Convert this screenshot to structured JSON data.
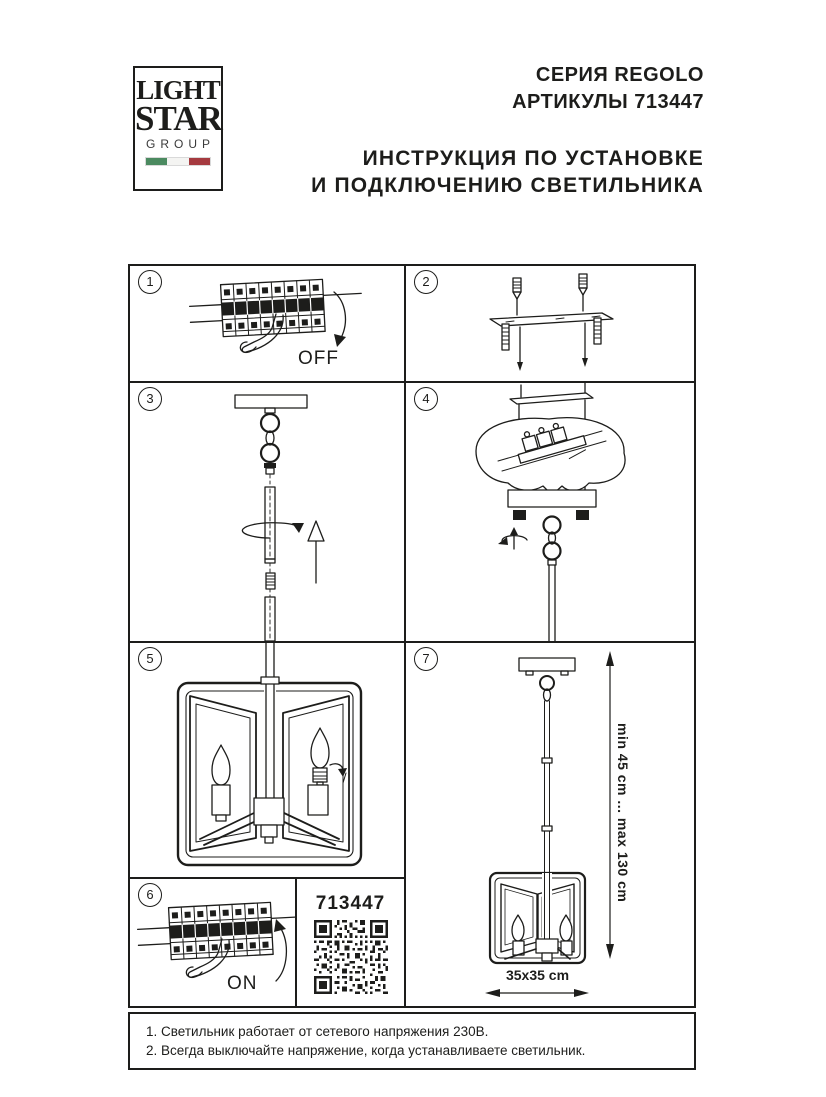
{
  "logo": {
    "light": "LIGHT",
    "star": "STAR",
    "group": "GROUP"
  },
  "header": {
    "series": "СЕРИЯ REGOLO",
    "articles": "АРТИКУЛЫ 713447",
    "instruction_line1": "ИНСТРУКЦИЯ ПО УСТАНОВКЕ",
    "instruction_line2": "И ПОДКЛЮЧЕНИЮ СВЕТИЛЬНИКА"
  },
  "steps": {
    "s1": {
      "num": "1",
      "label": "OFF"
    },
    "s2": {
      "num": "2"
    },
    "s3": {
      "num": "3"
    },
    "s4": {
      "num": "4"
    },
    "s5": {
      "num": "5"
    },
    "s6": {
      "num": "6",
      "label": "ON"
    },
    "s7": {
      "num": "7",
      "height_range": "min 45 cm ... max 130 cm",
      "size": "35x35 cm"
    }
  },
  "qr_cell": {
    "article": "713447"
  },
  "notes": {
    "n1": "1. Светильник работает от сетевого напряжения 230В.",
    "n2": "2. Всегда выключайте напряжение, когда устанавливаете светильник."
  },
  "colors": {
    "ink": "#1d1d1b",
    "flag_green": "#4b8a60",
    "flag_white": "#f4f4f2",
    "flag_red": "#a53a3f"
  }
}
